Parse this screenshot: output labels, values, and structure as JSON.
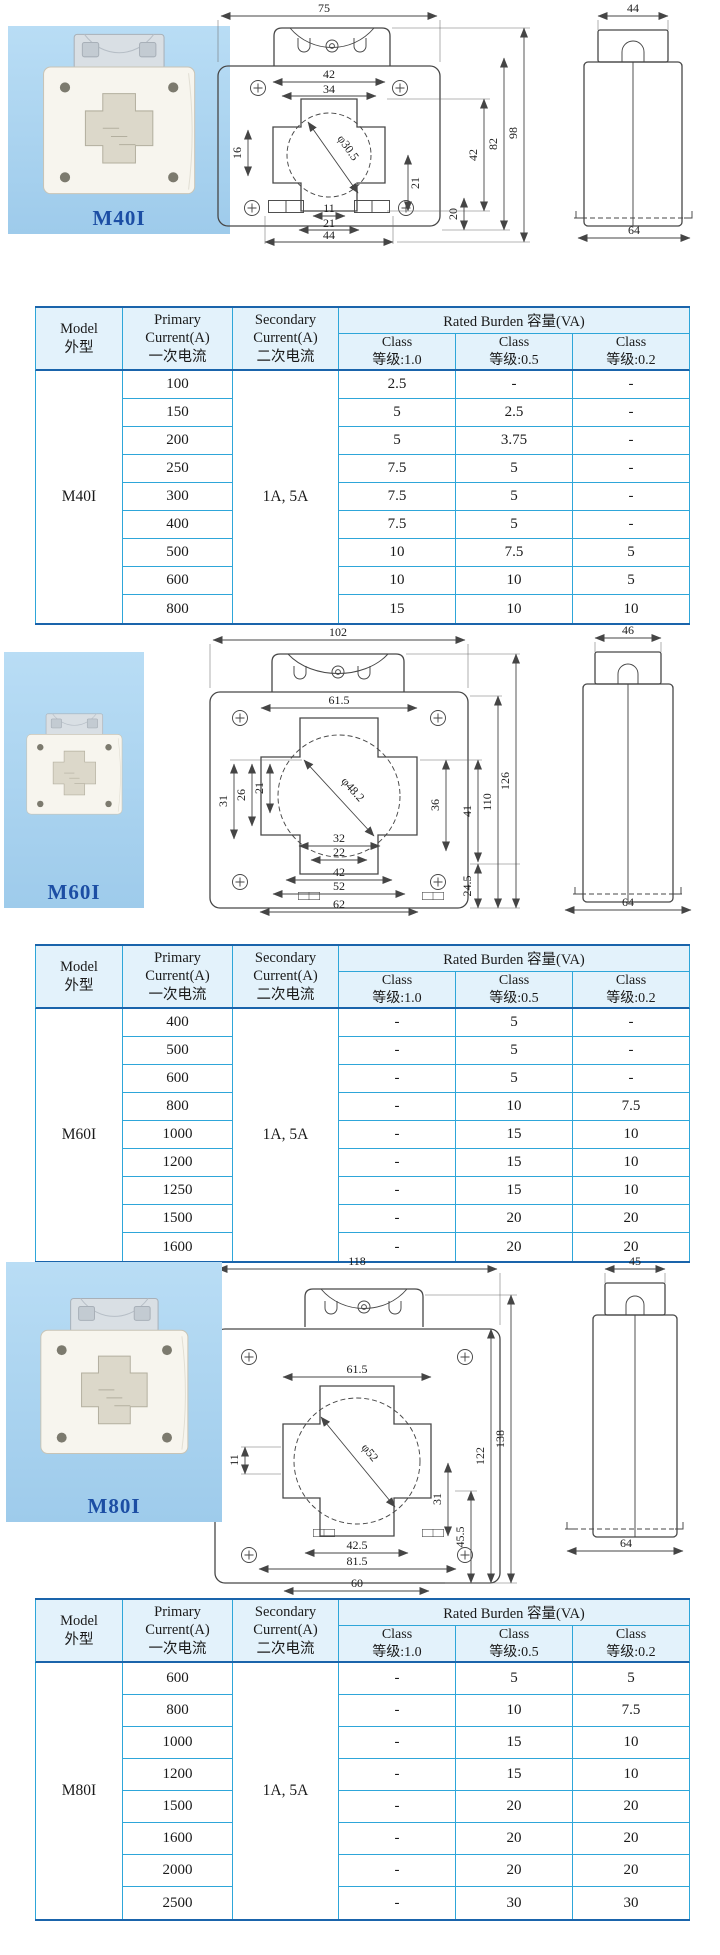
{
  "colors": {
    "photo_bg": "#a9d2ef",
    "table_border": "#2ea6d9",
    "table_border_dark": "#1a64ab",
    "header_bg": "#e3f2fb",
    "model_label": "#1c4ea4",
    "drawing_line": "#474747"
  },
  "header": {
    "model_en": "Model",
    "model_cn": "外型",
    "primary_l1": "Primary",
    "primary_l2": "Current(A)",
    "primary_l3": "一次电流",
    "secondary_l1": "Secondary",
    "secondary_l2": "Current(A)",
    "secondary_l3": "二次电流",
    "burden": "Rated Burden 容量(VA)",
    "class_label": "Class",
    "class_10": "等级:1.0",
    "class_05": "等级:0.5",
    "class_02": "等级:0.2"
  },
  "sections": [
    {
      "model": "M40I",
      "secondary": "1A, 5A",
      "front_dims": {
        "top_width": "75",
        "win_outer": "42",
        "win_inner": "34",
        "diameter": "φ30.5",
        "left_step": "16",
        "right_inner": "21",
        "notch": "11",
        "notch_outer": "21",
        "base_gap": "20",
        "height_window": "42",
        "height_body": "82",
        "height_total": "98",
        "mount_span": "44"
      },
      "side_dims": {
        "top": "44",
        "bottom": "64"
      },
      "rows": [
        {
          "primary": "100",
          "c10": "2.5",
          "c05": "-",
          "c02": "-"
        },
        {
          "primary": "150",
          "c10": "5",
          "c05": "2.5",
          "c02": "-"
        },
        {
          "primary": "200",
          "c10": "5",
          "c05": "3.75",
          "c02": "-"
        },
        {
          "primary": "250",
          "c10": "7.5",
          "c05": "5",
          "c02": "-"
        },
        {
          "primary": "300",
          "c10": "7.5",
          "c05": "5",
          "c02": "-"
        },
        {
          "primary": "400",
          "c10": "7.5",
          "c05": "5",
          "c02": "-"
        },
        {
          "primary": "500",
          "c10": "10",
          "c05": "7.5",
          "c02": "5"
        },
        {
          "primary": "600",
          "c10": "10",
          "c05": "10",
          "c02": "5"
        },
        {
          "primary": "800",
          "c10": "15",
          "c05": "10",
          "c02": "10"
        }
      ]
    },
    {
      "model": "M60I",
      "secondary": "1A, 5A",
      "front_dims": {
        "top_width": "102",
        "win_outer": "61.5",
        "diameter": "φ48.2",
        "left_a": "31",
        "left_b": "26",
        "left_c": "21",
        "mid_a": "32",
        "mid_b": "22",
        "bot_a": "42",
        "bot_b": "52",
        "bot_c": "62",
        "right_in": "36",
        "right_a": "41",
        "right_b": "24.5",
        "right_c": "110",
        "right_d": "126"
      },
      "side_dims": {
        "top": "46",
        "bottom": "64"
      },
      "rows": [
        {
          "primary": "400",
          "c10": "-",
          "c05": "5",
          "c02": "-"
        },
        {
          "primary": "500",
          "c10": "-",
          "c05": "5",
          "c02": "-"
        },
        {
          "primary": "600",
          "c10": "-",
          "c05": "5",
          "c02": "-"
        },
        {
          "primary": "800",
          "c10": "-",
          "c05": "10",
          "c02": "7.5"
        },
        {
          "primary": "1000",
          "c10": "-",
          "c05": "15",
          "c02": "10"
        },
        {
          "primary": "1200",
          "c10": "-",
          "c05": "15",
          "c02": "10"
        },
        {
          "primary": "1250",
          "c10": "-",
          "c05": "15",
          "c02": "10"
        },
        {
          "primary": "1500",
          "c10": "-",
          "c05": "20",
          "c02": "20"
        },
        {
          "primary": "1600",
          "c10": "-",
          "c05": "20",
          "c02": "20"
        }
      ]
    },
    {
      "model": "M80I",
      "secondary": "1A, 5A",
      "front_dims": {
        "top_width": "118",
        "win_outer": "61.5",
        "diameter": "φ52",
        "left_a": "11",
        "right_in": "31",
        "bot_a": "42.5",
        "bot_b": "81.5",
        "bot_c": "60",
        "right_a": "45.5",
        "right_b": "122",
        "right_c": "138"
      },
      "side_dims": {
        "top": "45",
        "bottom": "64"
      },
      "rows": [
        {
          "primary": "600",
          "c10": "-",
          "c05": "5",
          "c02": "5"
        },
        {
          "primary": "800",
          "c10": "-",
          "c05": "10",
          "c02": "7.5"
        },
        {
          "primary": "1000",
          "c10": "-",
          "c05": "15",
          "c02": "10"
        },
        {
          "primary": "1200",
          "c10": "-",
          "c05": "15",
          "c02": "10"
        },
        {
          "primary": "1500",
          "c10": "-",
          "c05": "20",
          "c02": "20"
        },
        {
          "primary": "1600",
          "c10": "-",
          "c05": "20",
          "c02": "20"
        },
        {
          "primary": "2000",
          "c10": "-",
          "c05": "20",
          "c02": "20"
        },
        {
          "primary": "2500",
          "c10": "-",
          "c05": "30",
          "c02": "30"
        }
      ]
    }
  ]
}
